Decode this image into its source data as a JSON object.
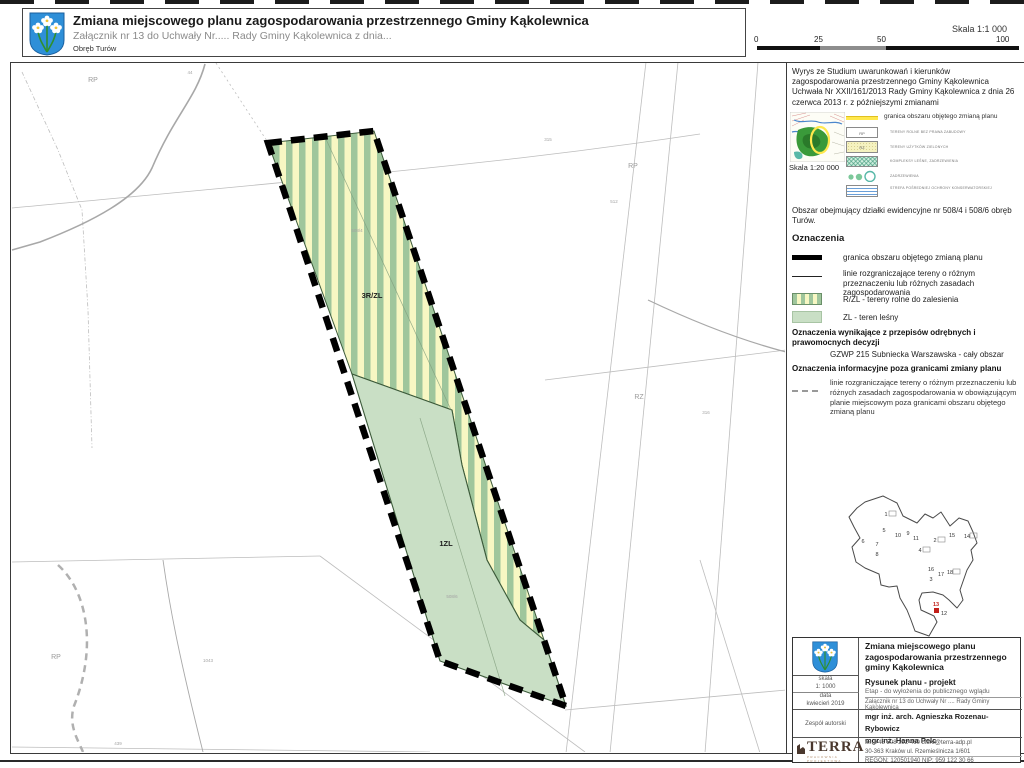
{
  "header": {
    "title": "Zmiana miejscowego planu zagospodarowania przestrzennego Gminy Kąkolewnica",
    "subtitle": "Załącznik nr 13 do Uchwały Nr..... Rady Gminy Kąkolewnica z dnia...",
    "area": "Obręb Turów"
  },
  "scalebar": {
    "label": "Skala   1:1 000",
    "ticks": [
      "0",
      "25",
      "50",
      "100"
    ]
  },
  "colors": {
    "stripe_green": "#9fc69c",
    "stripe_yellow": "#f7f7c3",
    "forest_green": "#c9dfc5",
    "boundary_black": "#000000",
    "crest_blue": "#2e8fd8",
    "studium_yellow": "#ffe84d",
    "terra_brown": "#4a382e",
    "highlight_red": "#c2201a"
  },
  "sidebar": {
    "wyrys_note": "Wyrys ze Studium uwarunkowań i kierunków zagospodarowania przestrzennego Gminy Kąkolewnica Uchwała Nr XXII/161/2013 Rady Gminy Kąkolewnica z dnia 26 czerwca 2013 r. z późniejszymi zmianami",
    "studium": {
      "scale": "Skala   1:20 000",
      "granica_label": "granica obszaru objętego zmianą planu",
      "items": [
        {
          "code": "RP",
          "label": "TERENY ROLNE BEZ PRAWA ZABUDOWY"
        },
        {
          "code": "RZ",
          "label": "TERENY UŻYTKÓW ZIELONYCH"
        },
        {
          "code": "",
          "label": "KOMPLEKSY LEŚNE, ZADRZEWIENIA"
        },
        {
          "code": "",
          "label": "ZADRZEWIENIA"
        },
        {
          "code": "",
          "label": "STREFA POŚREDNIEJ OCHRONY KONSERWATORSKIEJ"
        }
      ]
    },
    "area_note": "Obszar obejmujący działki ewidencyjne nr 508/4 i 508/6 obręb Turów.",
    "oznaczenia": {
      "heading": "Oznaczenia",
      "items": [
        {
          "label": "granica obszaru objętego zmianą planu"
        },
        {
          "label": "linie rozgraniczające tereny o różnym przeznaczeniu lub różnych zasadach zagospodarowania"
        },
        {
          "label": "R/ZL - tereny rolne do zalesienia"
        },
        {
          "label": "ZL - teren leśny"
        }
      ]
    },
    "przepisy": {
      "heading": "Oznaczenia wynikające z przepisów odrębnych i prawomocnych decyzji",
      "item": "GZWP 215 Subniecka Warszawska  - cały obszar"
    },
    "informacyjne": {
      "heading": "Oznaczenia informacyjne poza granicami zmiany planu",
      "item": "linie rozgraniczające tereny o różnym przeznaczeniu lub różnych zasadach zagospodarowania w obowiązującym planie miejscowym poza granicami obszaru objętego zmianą planu"
    }
  },
  "map": {
    "zone_labels": [
      {
        "t": "3R/ZL",
        "x": 372,
        "y": 298
      },
      {
        "t": "1ZL",
        "x": 446,
        "y": 546
      }
    ],
    "area_codes": [
      {
        "t": "RP",
        "x": 93,
        "y": 82
      },
      {
        "t": "RP",
        "x": 633,
        "y": 168
      },
      {
        "t": "RZ",
        "x": 639,
        "y": 399
      },
      {
        "t": "RP",
        "x": 56,
        "y": 659
      }
    ],
    "parcel_numbers": [
      {
        "t": "1043",
        "x": 208,
        "y": 662
      },
      {
        "t": "439",
        "x": 118,
        "y": 745
      },
      {
        "t": "508/4",
        "x": 357,
        "y": 232
      },
      {
        "t": "508/6",
        "x": 452,
        "y": 598
      },
      {
        "t": "512",
        "x": 614,
        "y": 203
      },
      {
        "t": "316",
        "x": 706,
        "y": 414
      },
      {
        "t": "44",
        "x": 190,
        "y": 74
      },
      {
        "t": "315",
        "x": 548,
        "y": 141
      }
    ]
  },
  "locator": {
    "numbers": [
      {
        "n": "1",
        "x": 41,
        "y": 28,
        "box": true
      },
      {
        "n": "5",
        "x": 39,
        "y": 44
      },
      {
        "n": "6",
        "x": 18,
        "y": 55
      },
      {
        "n": "7",
        "x": 32,
        "y": 58
      },
      {
        "n": "8",
        "x": 32,
        "y": 68
      },
      {
        "n": "10",
        "x": 53,
        "y": 49
      },
      {
        "n": "9",
        "x": 63,
        "y": 47
      },
      {
        "n": "11",
        "x": 71,
        "y": 52
      },
      {
        "n": "2",
        "x": 90,
        "y": 54,
        "box": true
      },
      {
        "n": "4",
        "x": 75,
        "y": 64,
        "box": true
      },
      {
        "n": "15",
        "x": 107,
        "y": 49
      },
      {
        "n": "14",
        "x": 122,
        "y": 50,
        "box": true
      },
      {
        "n": "16",
        "x": 86,
        "y": 83
      },
      {
        "n": "3",
        "x": 86,
        "y": 93
      },
      {
        "n": "17",
        "x": 96,
        "y": 88
      },
      {
        "n": "18",
        "x": 105,
        "y": 86,
        "box": true
      },
      {
        "n": "12",
        "x": 99,
        "y": 127
      },
      {
        "n": "13",
        "x": 91,
        "y": 118,
        "red": true
      }
    ]
  },
  "titleblock": {
    "title": "Zmiana miejscowego planu zagospodarowania przestrzennego gminy Kąkolewnica",
    "skala_label": "skala",
    "skala": "1: 1000",
    "data_label": "data",
    "data": "kwiecień 2019",
    "rysunek": "Rysunek planu - projekt",
    "etap": "Etap - do wyłożenia do publicznego wglądu",
    "zalacznik": "Załącznik nr 13 do Uchwały Nr .... Rady Gminy Kąkolewnica",
    "zespol_label": "Zespół autorski",
    "authors": [
      "mgr inż. arch. Agnieszka Rozenau-Rybowicz",
      "mgr inż. Hanna Pelc"
    ],
    "terra": "TERRA",
    "terra_sub": "PRACOWNIA PROJEKTOWA",
    "contact": [
      "tel. +48 508 292 460 biuro@terra-adp.pl",
      "30-363 Kraków ul. Rzemieślnicza 1/601",
      "REGON: 120501940 NIP: 959 122 30 66"
    ]
  }
}
